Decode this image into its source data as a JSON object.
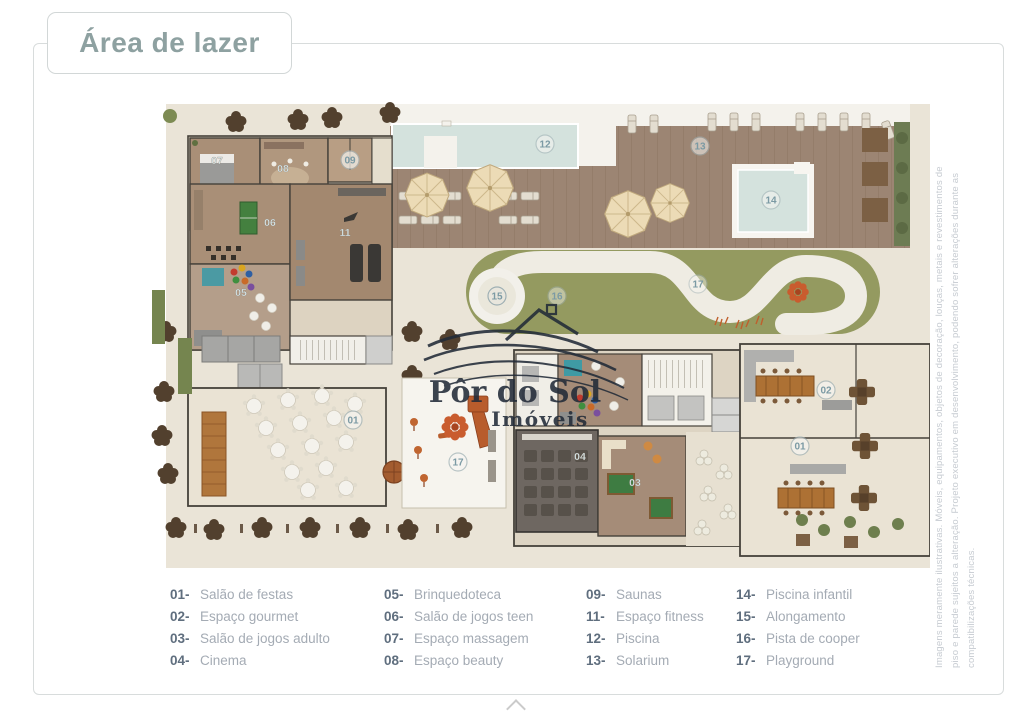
{
  "page": {
    "title": "Área de lazer"
  },
  "watermark": {
    "name": "Pôr do Sol",
    "suffix": "Imóveis"
  },
  "legend": {
    "columns": [
      {
        "items": [
          {
            "num": "01-",
            "label": "Salão de festas"
          },
          {
            "num": "02-",
            "label": "Espaço gourmet"
          },
          {
            "num": "03-",
            "label": "Salão de jogos adulto"
          },
          {
            "num": "04-",
            "label": "Cinema"
          }
        ]
      },
      {
        "items": [
          {
            "num": "05-",
            "label": "Brinquedoteca"
          },
          {
            "num": "06-",
            "label": "Salão de jogos teen"
          },
          {
            "num": "07-",
            "label": "Espaço massagem"
          },
          {
            "num": "08-",
            "label": "Espaço beauty"
          }
        ]
      },
      {
        "items": [
          {
            "num": "09-",
            "label": "Saunas"
          },
          {
            "num": "11-",
            "label": "Espaço fitness"
          },
          {
            "num": "12-",
            "label": "Piscina"
          },
          {
            "num": "13-",
            "label": "Solarium"
          }
        ]
      },
      {
        "items": [
          {
            "num": "14-",
            "label": "Piscina infantil"
          },
          {
            "num": "15-",
            "label": "Alongamento"
          },
          {
            "num": "16-",
            "label": "Pista de cooper"
          },
          {
            "num": "17-",
            "label": "Playground"
          }
        ]
      }
    ]
  },
  "plan": {
    "markers": {
      "m01a": "01",
      "m01b": "01",
      "m02": "02",
      "m03": "03",
      "m04": "04",
      "m05": "05",
      "m06": "06",
      "m07": "07",
      "m08": "08",
      "m09": "09",
      "m11": "11",
      "m12": "12",
      "m13": "13",
      "m14": "14",
      "m15": "15",
      "m16": "16",
      "m17a": "17",
      "m17b": "17"
    }
  },
  "disclaimer": {
    "line1": "Imagens meramente ilustrativas. Móveis, equipamentos, objetos de decoração, louças, metais e revestimentos de",
    "line2": "piso e parede sujeitos a alteração. Projeto executivo em desenvolvimento, podendo sofrer alterações durante as",
    "line3": "compatibilizações técnicas."
  },
  "colors": {
    "title_teal": "#8ea1a1",
    "legend_number": "#5f6e7e",
    "legend_label": "#a4abb4",
    "watermark_navy": "#222b38",
    "pool_blue": "#d4e2dd",
    "deck_brown": "#9c8573",
    "grass_green": "#949a60",
    "track_white": "#efece3",
    "marker_teal": "#7b9aa4"
  }
}
